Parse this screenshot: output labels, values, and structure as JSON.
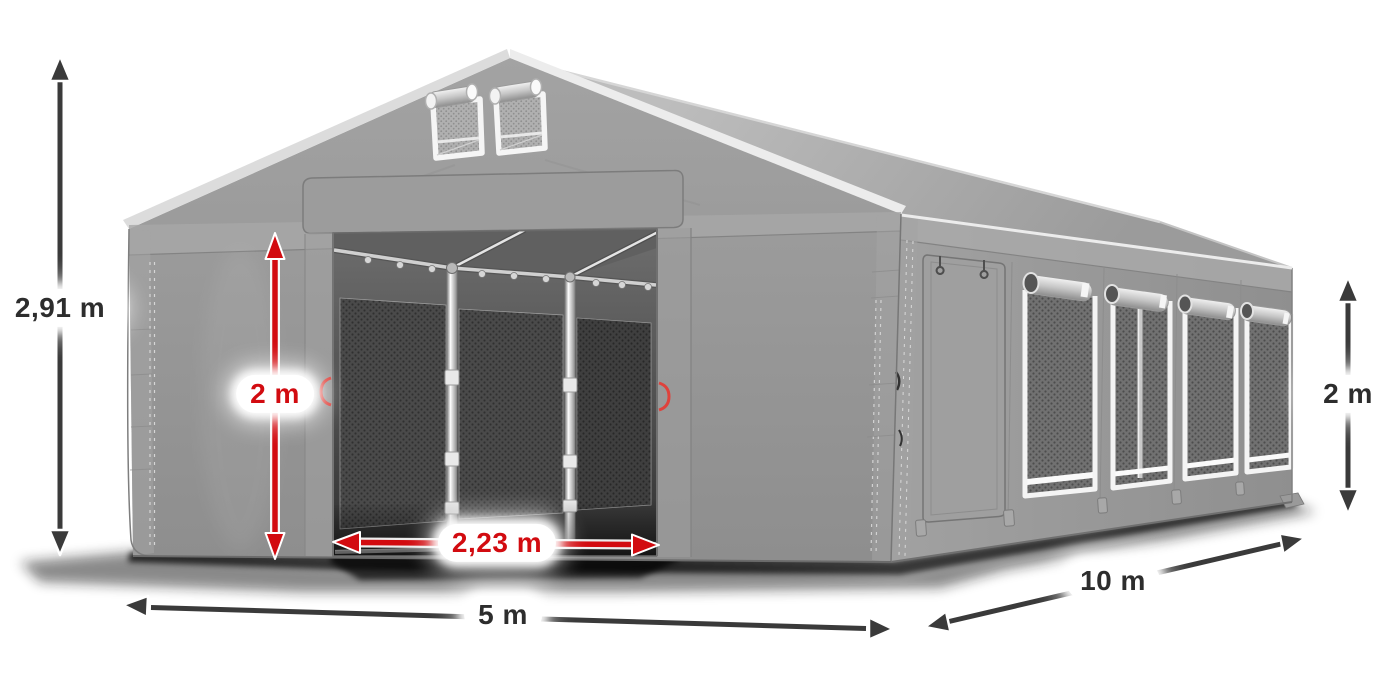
{
  "labels": {
    "total_height": "2,91 m",
    "entrance_height": "2 m",
    "entrance_width": "2,23 m",
    "front_width": "5 m",
    "side_length": "10 m",
    "wall_height": "2 m"
  },
  "colors": {
    "background": "#ffffff",
    "pill_bg": "#ffffff",
    "label_dark": "#2d2d2d",
    "accent_red": "#d20b10",
    "arrow_dark": "#3a3a3a",
    "tent_gray": "#9a9a9a"
  }
}
